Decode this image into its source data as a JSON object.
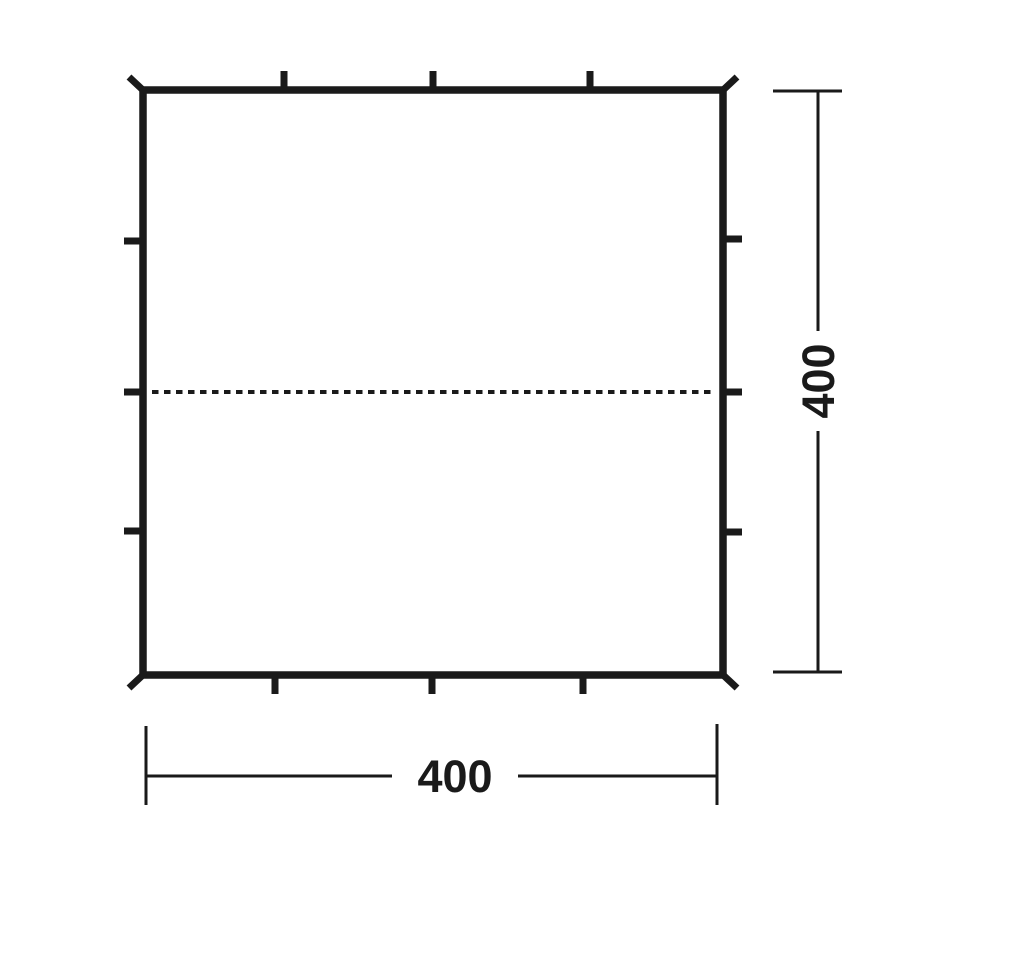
{
  "colors": {
    "line": "#1a1a1a",
    "background": "#ffffff"
  },
  "dimensions": {
    "width_label": "400",
    "height_label": "400"
  }
}
